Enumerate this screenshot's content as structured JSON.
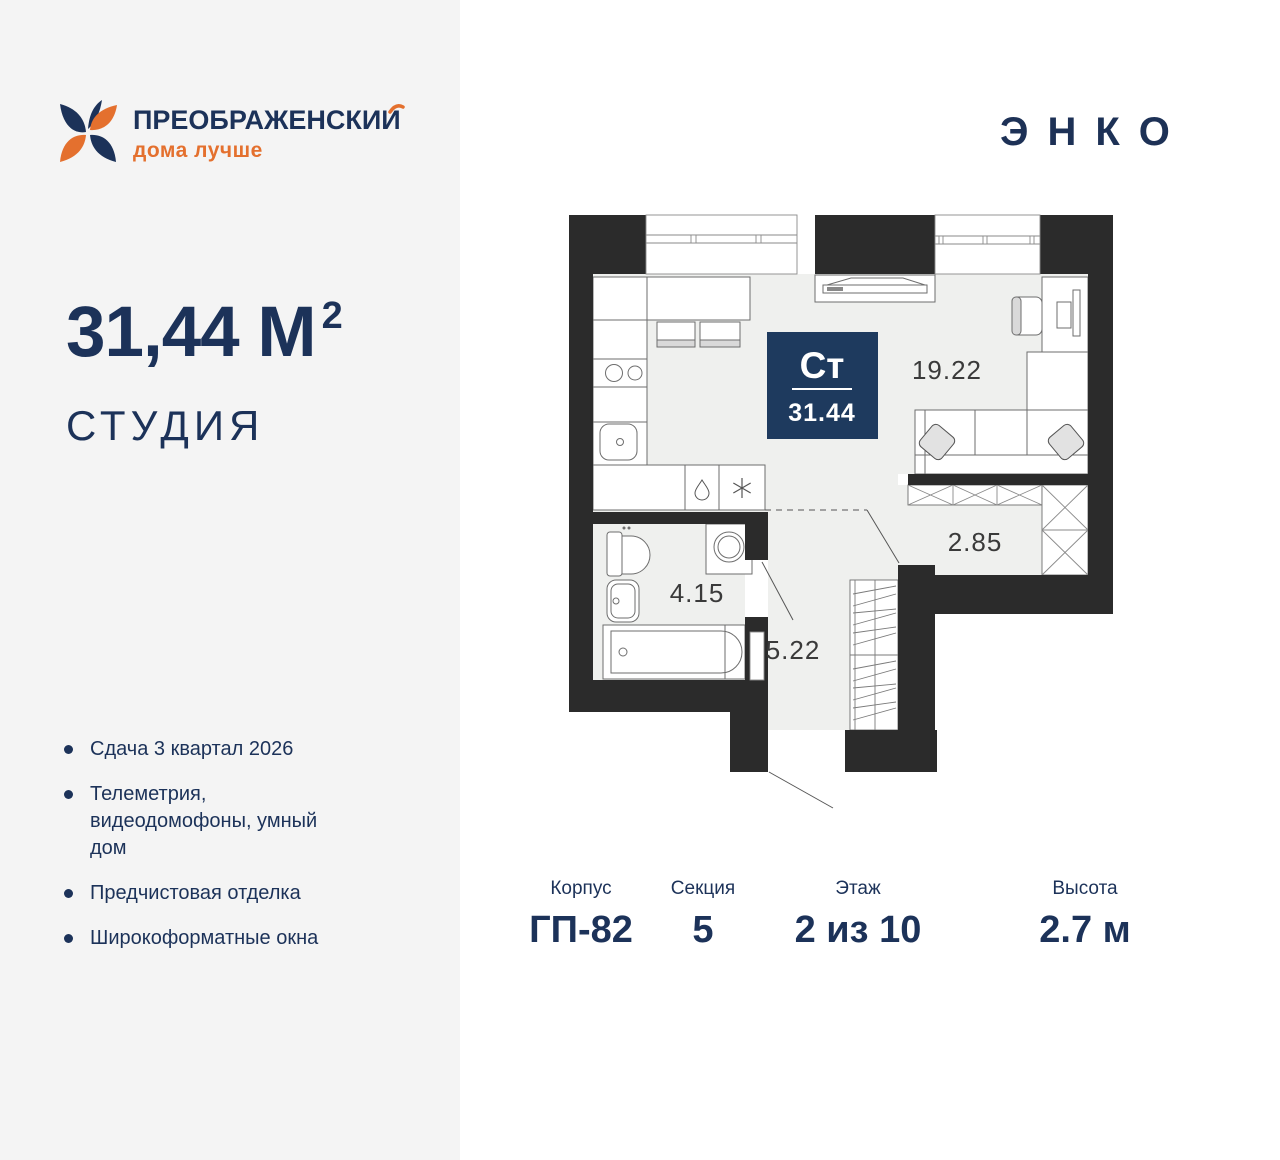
{
  "brand": {
    "title": "ПРЕОБРАЖЕНСКИЙ",
    "title_prefix": "ПРЕОБРАЖЕНСКИ",
    "title_last": "И",
    "tagline": "дома лучше"
  },
  "developer": {
    "logo": "ЭНКО"
  },
  "flat": {
    "area": "31,44",
    "unit": "М",
    "sup": "2",
    "type": "СТУДИЯ"
  },
  "features": [
    "Сдача 3 квартал 2026",
    "Телеметрия, видеодомофоны, умный дом",
    "Предчистовая отделка",
    "Широкоформатные окна"
  ],
  "plan": {
    "badge": {
      "type_short": "Ст",
      "area": "31.44"
    },
    "rooms": {
      "living": "19.22",
      "bathroom": "4.15",
      "hall": "5.22",
      "wardrobe": "2.85"
    }
  },
  "info": [
    {
      "label": "Корпус",
      "value": "ГП-82"
    },
    {
      "label": "Секция",
      "value": "5"
    },
    {
      "label": "Этаж",
      "value": "2 из 10"
    },
    {
      "label": "Высота",
      "value": "2.7 м"
    }
  ],
  "colors": {
    "navy": "#1c3259",
    "orange": "#e4702e",
    "wall": "#2b2b2b",
    "floor": "#eff0ee",
    "badge": "#1e3a5e"
  }
}
